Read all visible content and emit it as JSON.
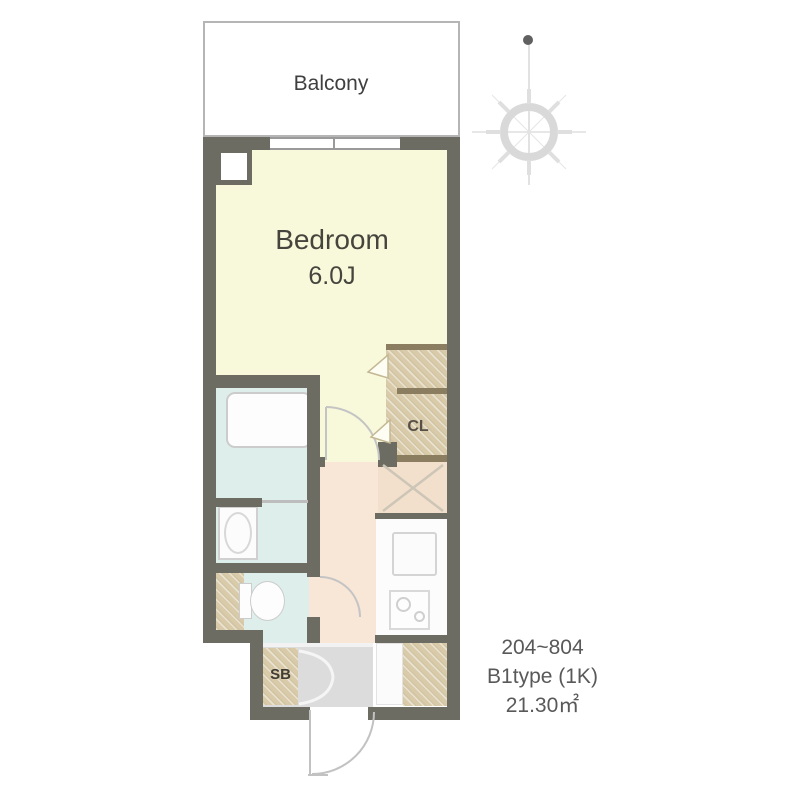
{
  "floorplan": {
    "balcony": {
      "label": "Balcony"
    },
    "bedroom": {
      "label": "Bedroom",
      "size": "6.0J"
    },
    "closet": {
      "label": "CL"
    },
    "shoebox": {
      "label": "SB"
    },
    "annotation": {
      "units": "204~804",
      "type": "B1type (1K)",
      "area": "21.30㎡"
    }
  },
  "colors": {
    "wall": "#6c6c63",
    "bedroom_floor": "#f8f8da",
    "bathroom_floor": "#deeeea",
    "hall_floor": "#f8e6d7",
    "storage_tan": "#d9cba9",
    "closet_trim": "#8b7d60",
    "entrance_floor": "#dcdcdc",
    "balcony_border": "#b5b5b5",
    "annotation_text": "#595959"
  }
}
